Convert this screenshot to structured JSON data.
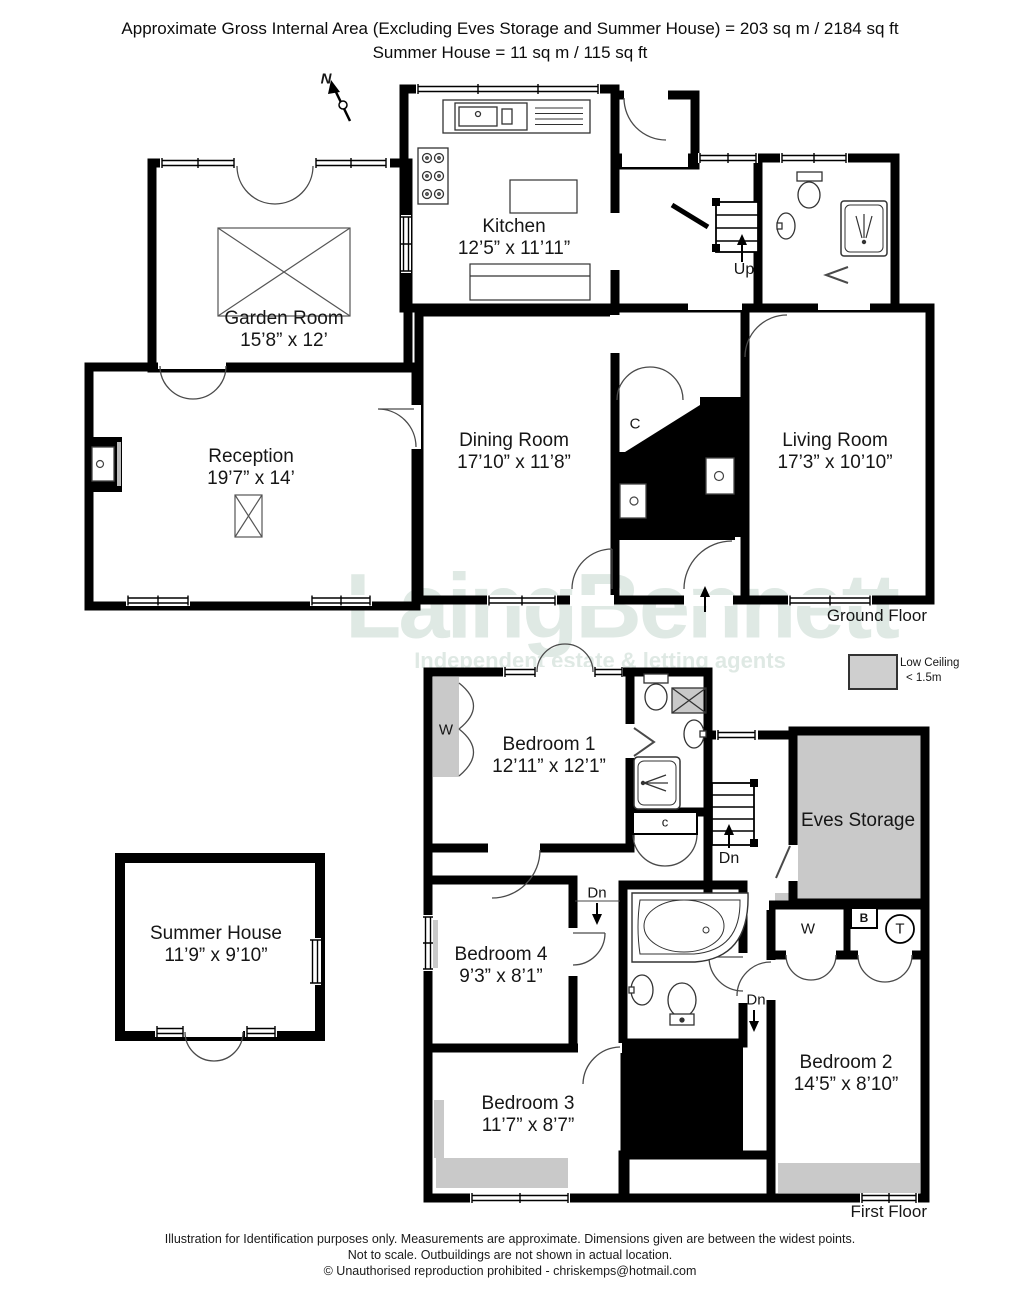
{
  "header": {
    "line1": "Approximate Gross Internal Area (Excluding Eves Storage and Summer House)  = 203 sq m /  2184 sq ft",
    "line2": "Summer House  =  11 sq m / 115 sq ft"
  },
  "watermark": {
    "brand": "LaingBennett",
    "tagline": "Independent estate & letting agents"
  },
  "legend": {
    "title": "Low Ceiling",
    "value": "< 1.5m"
  },
  "compass": {
    "north": "N"
  },
  "ground_floor": {
    "label": "Ground Floor",
    "rooms": {
      "garden_room": {
        "name": "Garden Room",
        "dims": "15’8” x 12’"
      },
      "kitchen": {
        "name": "Kitchen",
        "dims": "12’5” x 11’11”"
      },
      "reception": {
        "name": "Reception",
        "dims": "19’7” x 14’"
      },
      "dining_room": {
        "name": "Dining Room",
        "dims": "17’10” x 11’8”"
      },
      "living_room": {
        "name": "Living Room",
        "dims": "17’3” x 10’10”"
      }
    },
    "annotations": {
      "up": "Up",
      "cupboard": "C"
    }
  },
  "first_floor": {
    "label": "First Floor",
    "rooms": {
      "bedroom1": {
        "name": "Bedroom 1",
        "dims": "12’11” x 12’1”"
      },
      "bedroom2": {
        "name": "Bedroom 2",
        "dims": "14’5” x 8’10”"
      },
      "bedroom3": {
        "name": "Bedroom 3",
        "dims": "11’7” x 8’7”"
      },
      "bedroom4": {
        "name": "Bedroom 4",
        "dims": "9’3” x 8’1”"
      },
      "eves_storage": {
        "name": "Eves Storage"
      }
    },
    "annotations": {
      "dn_landing": "Dn",
      "dn_hall": "Dn",
      "dn_corridor": "Dn",
      "cupboard": "c",
      "wardrobe1": "W",
      "wardrobe2": "W",
      "boiler": "B",
      "tank": "T"
    }
  },
  "outbuilding": {
    "summer_house": {
      "name": "Summer House",
      "dims": "11’9” x 9’10”"
    }
  },
  "footer": {
    "line1": "Illustration for Identification purposes only.  Measurements are approximate. Dimensions given are between the widest points.",
    "line2": "Not to scale.  Outbuildings are not shown in actual location.",
    "line3": "© Unauthorised reproduction prohibited  -  chriskemps@hotmail.com"
  },
  "colors": {
    "wall": "#000000",
    "low_ceiling_gray": "#c9c9c9",
    "watermark": "#dfe9e4"
  },
  "fixtures": [
    "north-arrow-icon",
    "kitchen-sink-icon",
    "stove-icon",
    "counter-icon",
    "skylight-icon",
    "fireplace-icon",
    "stairs-up-icon",
    "stairs-down-icon",
    "toilet-icon",
    "basin-icon",
    "shower-icon",
    "corner-bath-icon",
    "wardrobe-doors-icon",
    "entry-arrow-icon"
  ]
}
